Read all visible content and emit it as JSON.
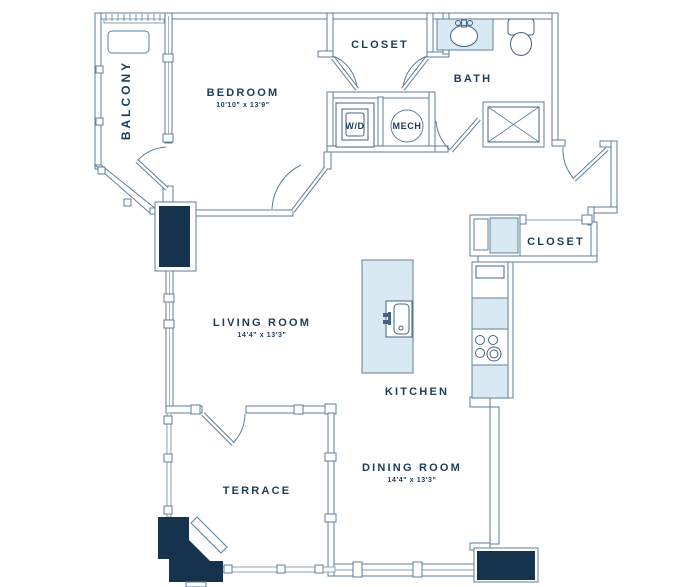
{
  "plan": {
    "type": "apartment-floor-plan",
    "rooms": {
      "balcony": {
        "label": "BALCONY"
      },
      "bedroom": {
        "label": "BEDROOM",
        "dims": "10'10\" x 13'9\""
      },
      "closet_top": {
        "label": "CLOSET"
      },
      "bath": {
        "label": "BATH"
      },
      "washer_dryer": {
        "label": "W/D"
      },
      "mech": {
        "label": "MECH"
      },
      "closet_entry": {
        "label": "CLOSET"
      },
      "living_room": {
        "label": "LIVING ROOM",
        "dims": "14'4\" x 13'3\""
      },
      "kitchen": {
        "label": "KITCHEN"
      },
      "terrace": {
        "label": "TERRACE"
      },
      "dining_room": {
        "label": "DINING ROOM",
        "dims": "14'4\" x 13'3\""
      }
    },
    "colors": {
      "wall_line": "#5d7e99",
      "rail_line": "#8aa3b6",
      "fixture_line": "#44637f",
      "dark_fill": "#16334d",
      "light_blue_fill": "#d9e9f4",
      "label_text": "#1d3b5a",
      "background": "#ffffff"
    }
  }
}
